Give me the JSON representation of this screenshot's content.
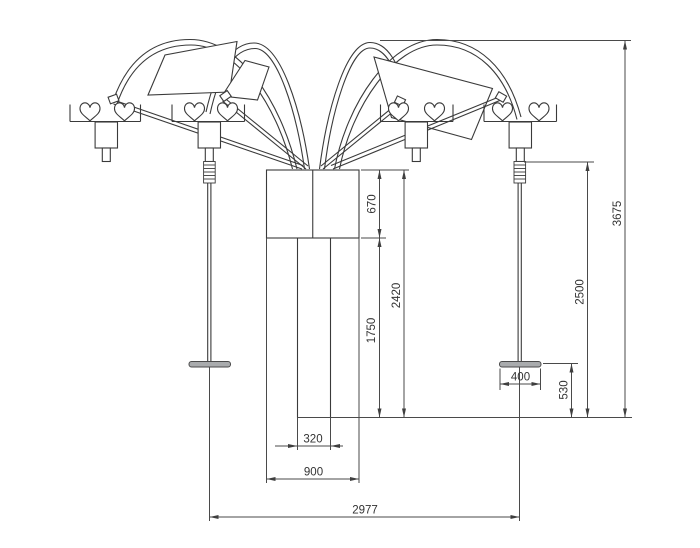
{
  "drawing": {
    "type": "technical-dimension-drawing",
    "subject": "four-arm heart swing structure, front elevation",
    "colors": {
      "line": "#3a3a3a",
      "dimension_line": "#4a4a4a",
      "text": "#333333",
      "seat_fill": "#a9abad",
      "background": "#ffffff"
    },
    "dimensions": {
      "hub_height": "670",
      "post_height": "1750",
      "column_height": "2420",
      "total_height": "3675",
      "rope_drop_height": "2500",
      "seat_width": "400",
      "seat_clearance": "530",
      "column_width": "320",
      "hub_width": "900",
      "swing_span": "2977"
    }
  }
}
